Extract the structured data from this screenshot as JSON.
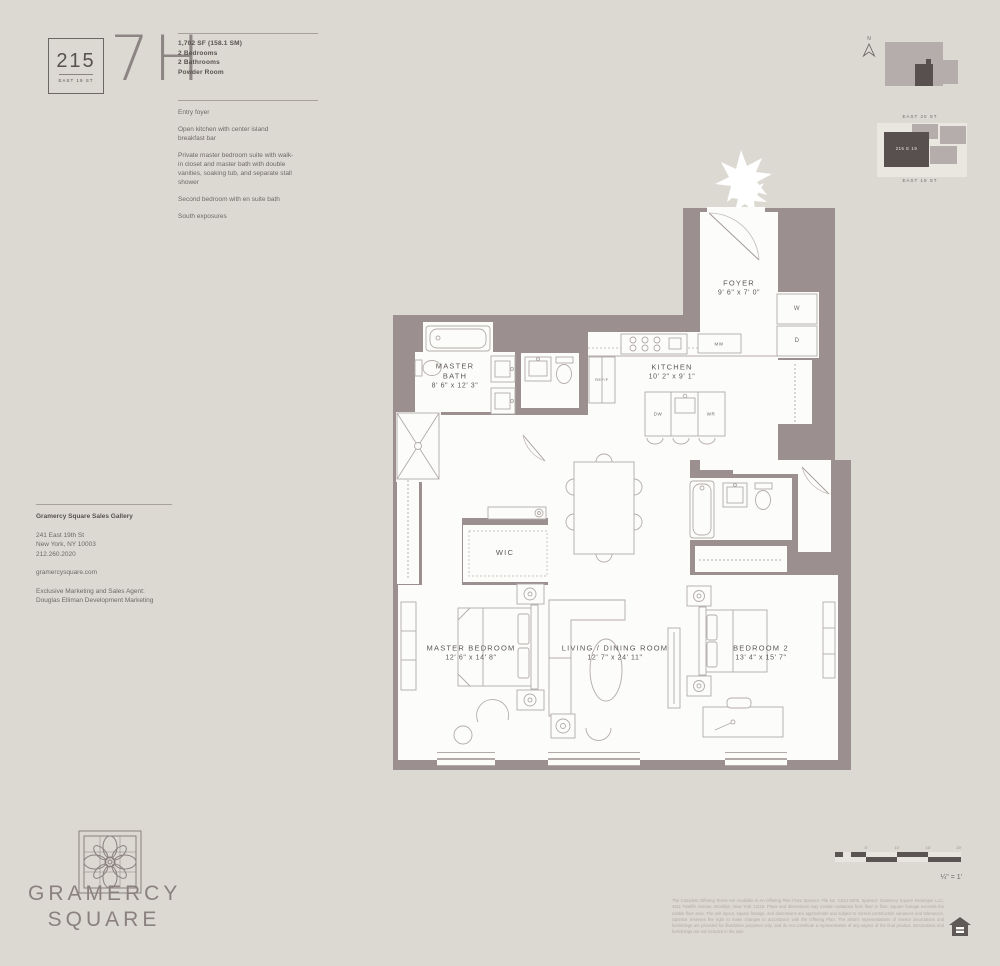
{
  "colors": {
    "page_bg": "#dcd9d2",
    "wall": "#9b8f90",
    "floor": "#fcfcfa",
    "fixture_line": "#b2abaa",
    "text_dark": "#57514f",
    "text_mid": "#6e6866",
    "site_dark": "#57504f",
    "site_mid": "#b5adab",
    "site_light": "#eae7e1"
  },
  "header": {
    "badge_number": "215",
    "badge_street": "EAST 19 ST",
    "unit": "7H",
    "stats": [
      "1,702 SF (158.1 SM)",
      "2 Bedrooms",
      "2 Bathrooms",
      "Powder Room"
    ],
    "features": [
      "Entry foyer",
      "Open kitchen with center island breakfast bar",
      "Private master bedroom suite with walk-in closet and master bath with double vanities, soaking tub, and separate stall shower",
      "Second bedroom with en suite bath",
      "South exposures"
    ]
  },
  "locator": {
    "north": "N",
    "street_top": "EAST 20 ST",
    "street_bottom": "EAST 19 ST",
    "building": "215 E 19"
  },
  "floorplan": {
    "rooms": {
      "foyer": {
        "name": "FOYER",
        "dims": "9' 6\" x 7' 0\""
      },
      "kitchen": {
        "name": "KITCHEN",
        "dims": "10' 2\" x 9' 1\""
      },
      "master_bath": {
        "name": "MASTER BATH",
        "dims": "8' 6\" x 12' 3\""
      },
      "wic": {
        "name": "WIC"
      },
      "living": {
        "name": "LIVING / DINING ROOM",
        "dims": "12' 7\" x 24' 11\""
      },
      "master_bedroom": {
        "name": "MASTER BEDROOM",
        "dims": "12' 6\" x 14' 8\""
      },
      "bedroom2": {
        "name": "BEDROOM 2",
        "dims": "13' 4\" x 15' 7\""
      }
    },
    "appliances": {
      "washer": "W",
      "dryer": "D",
      "microwave": "MW",
      "dishwasher": "DW",
      "wine_ref": "WR",
      "fridge": "REF/F"
    }
  },
  "contact": {
    "title": "Gramercy Square Sales Gallery",
    "address": [
      "241 East 19th St",
      "New York, NY 10003",
      "212.260.2020"
    ],
    "website": "gramercysquare.com",
    "agent": [
      "Exclusive Marketing and Sales Agent:",
      "Douglas Elliman Development Marketing"
    ]
  },
  "logo": {
    "line1": "GRAMERCY",
    "line2": "SQUARE"
  },
  "scale": {
    "ticks": [
      "5'",
      "10'",
      "15'",
      "20'"
    ],
    "ratio": "¼\" = 1'"
  },
  "disclaimer": {
    "text": "The Complete Offering Terms Are Available In An Offering Plan From Sponsor. File No. CD14-0306. Sponsor: Gramercy Square Developer LLC, 4611 Twelfth Avenue, Brooklyn, New York 11219. Plans and dimensions may contain variations from floor to floor. Square footage exceeds the usable floor area. The unit layout, square footage, and dimensions are approximate and subject to normal construction variances and tolerances. Sponsor reserves the right to make changes in accordance with the Offering Plan. The artist's representations of interior decorations and furnishings are provided for illustrative purposes only, and do not constitute a representation of any aspect of the final product. Decorations and furnishings are not included in the sale."
  }
}
